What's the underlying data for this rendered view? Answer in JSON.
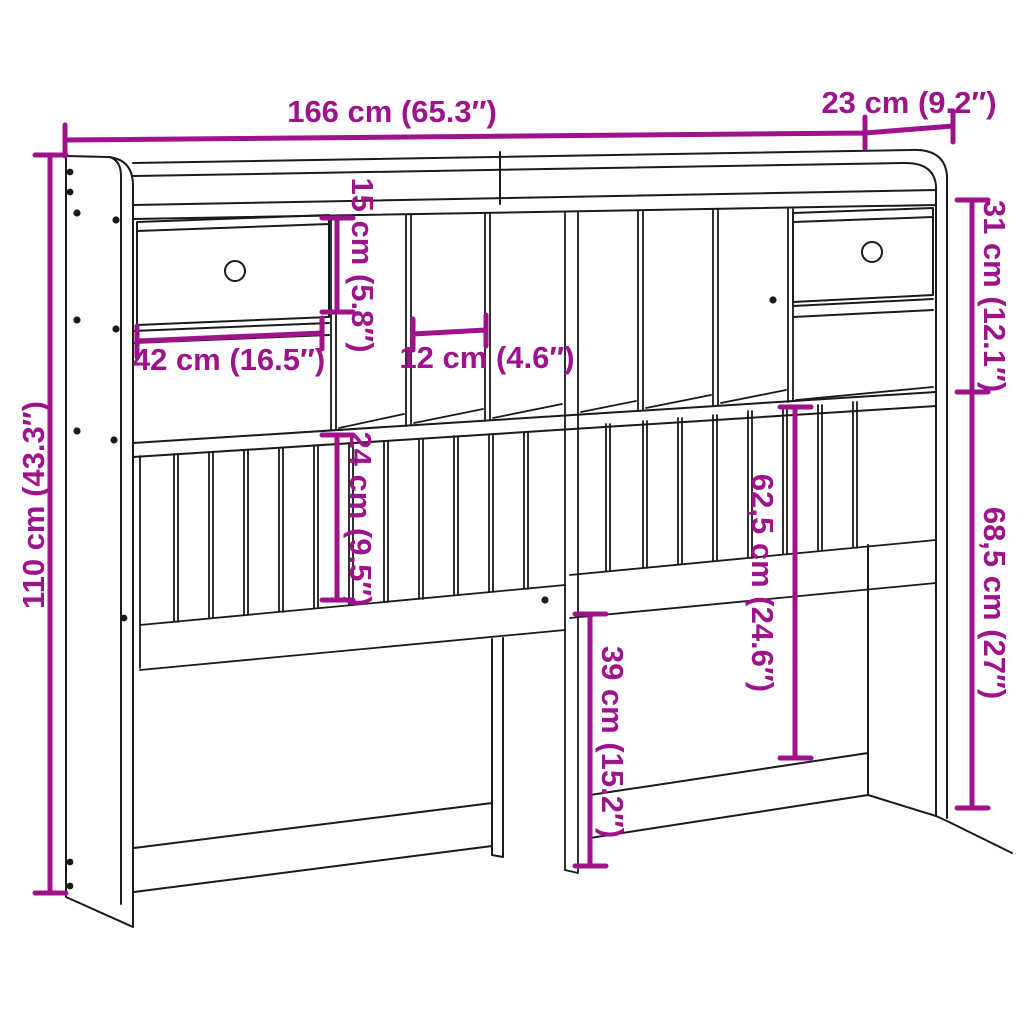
{
  "diagram": {
    "colors": {
      "dimension_annotation": "#9E128C",
      "line_art": "#1A1A1A",
      "background": "#FFFFFF"
    },
    "dimensions": {
      "total_width": "166 cm (65.3″)",
      "total_depth": "23 cm (9.2″)",
      "total_height": "110 cm (43.3″)",
      "upper_section_height": "31 cm (12.1″)",
      "lower_section_height": "68,5 cm (27″)",
      "cubby_height": "15 cm (5.8″)",
      "drawer_width": "42 cm (16.5″)",
      "cubby_slot_width": "12 cm (4.6″)",
      "slat_panel_height": "24 cm (9.5″)",
      "mid_section_height": "62,5 cm (24.6″)",
      "leg_section_height": "39 cm (15.2″)"
    }
  }
}
